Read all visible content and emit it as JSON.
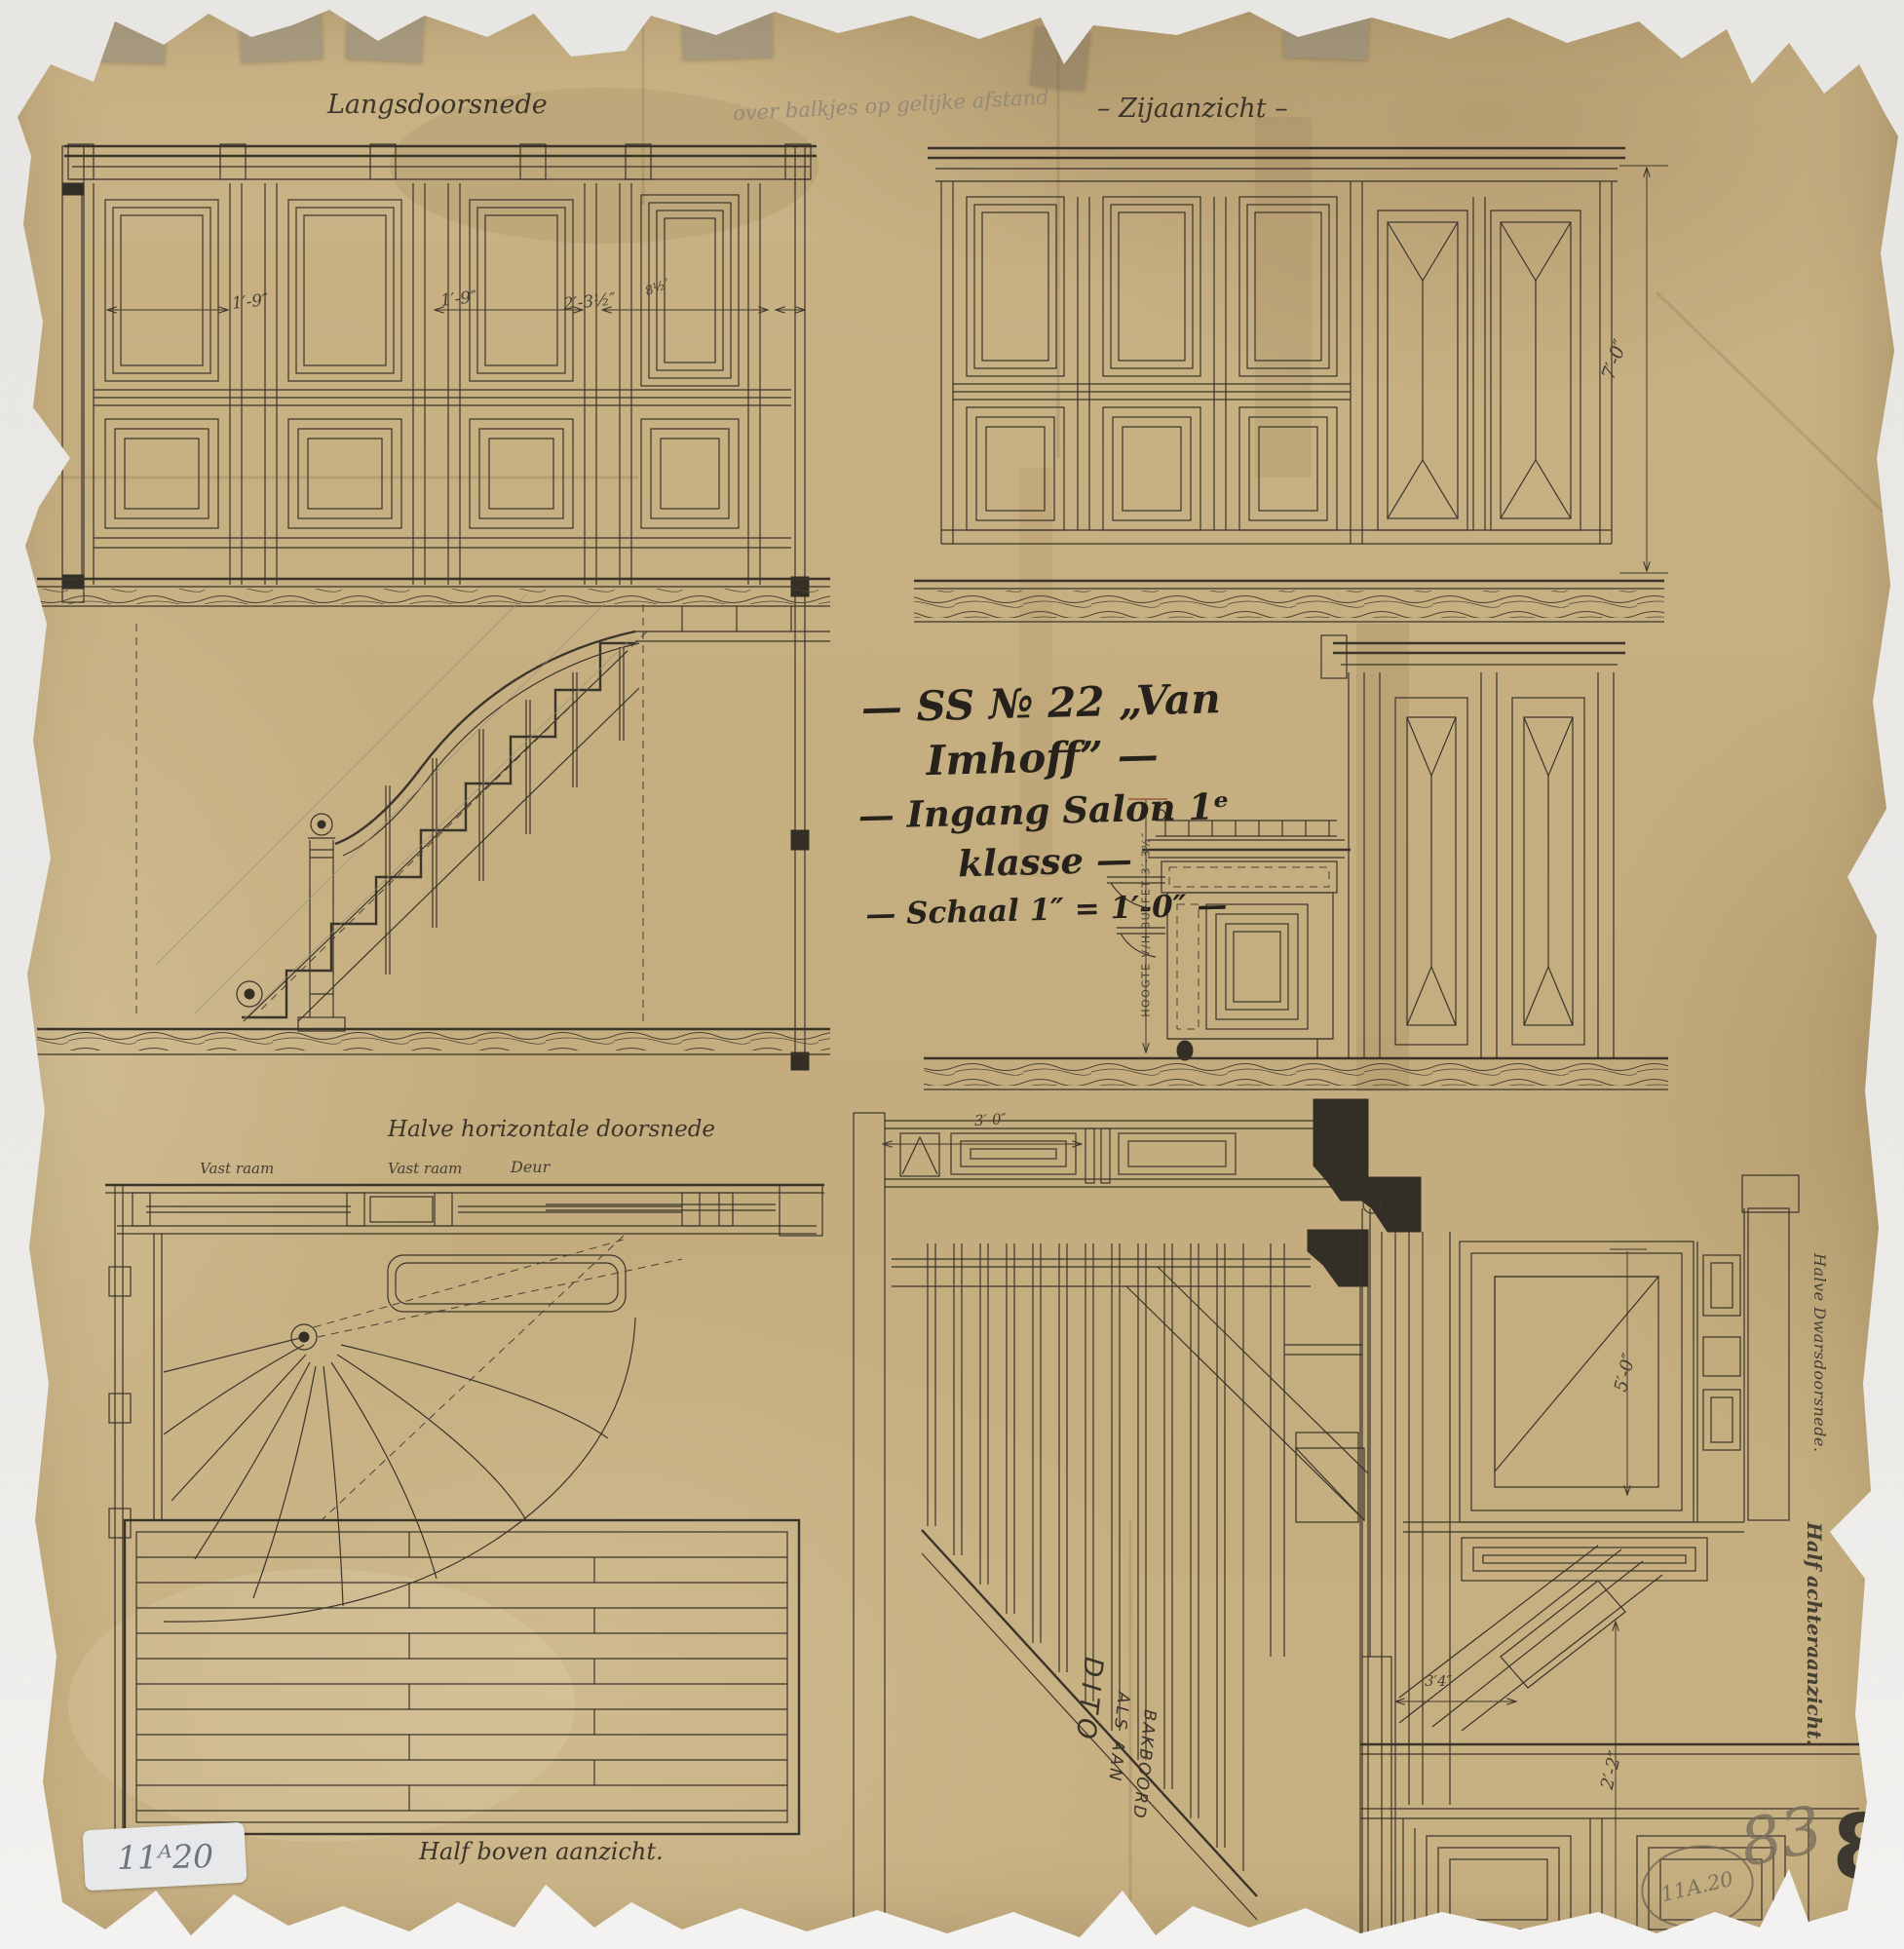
{
  "sheet": {
    "pencil_note_top": "over balkjes op gelijke afstand",
    "title": {
      "line1": "— SS № 22 „Van Imhoff” —",
      "line2": "— Ingang Salon 1ᵉ klasse —",
      "line3": "— Schaal 1″ = 1′-0″ —"
    }
  },
  "views": {
    "langsdoorsnede": {
      "label": "Langsdoorsnede",
      "dims": [
        "1′-9″",
        "1′-9″",
        "2′-3½″",
        "8½″"
      ]
    },
    "zijaanzicht": {
      "label": "– Zijaanzicht –",
      "height_dim": "7′-0″"
    },
    "buffet_section": {
      "height_note": "HOOGTE V/H BUFFET 3′-3½″"
    },
    "plan": {
      "label": "Halve horizontale doorsnede",
      "top_labels": [
        "Vast raam",
        "Vast raam",
        "Deur"
      ],
      "bottom_label": "Half boven aanzicht."
    },
    "bakboord_note": {
      "line1": "DITO",
      "line2": "ALS AAN",
      "line3": "BAKBOORD",
      "dim": "3′-0″"
    },
    "dwarsdoorsnede": {
      "label": "Halve Dwarsdoorsnede.",
      "label2": "Half achteraanzicht.",
      "dims": [
        "5′-0″",
        "2′-2″",
        "3′4″"
      ]
    }
  },
  "stamps": {
    "sticker_label": "11ᴬ20",
    "pencil_circled": "11A.20",
    "pencil_number": "83",
    "ink_number": "83"
  },
  "colors": {
    "paper": "#c9b285",
    "backdrop": "#ebeae7",
    "ink": "#3b342b",
    "pencil": "#958a77"
  }
}
